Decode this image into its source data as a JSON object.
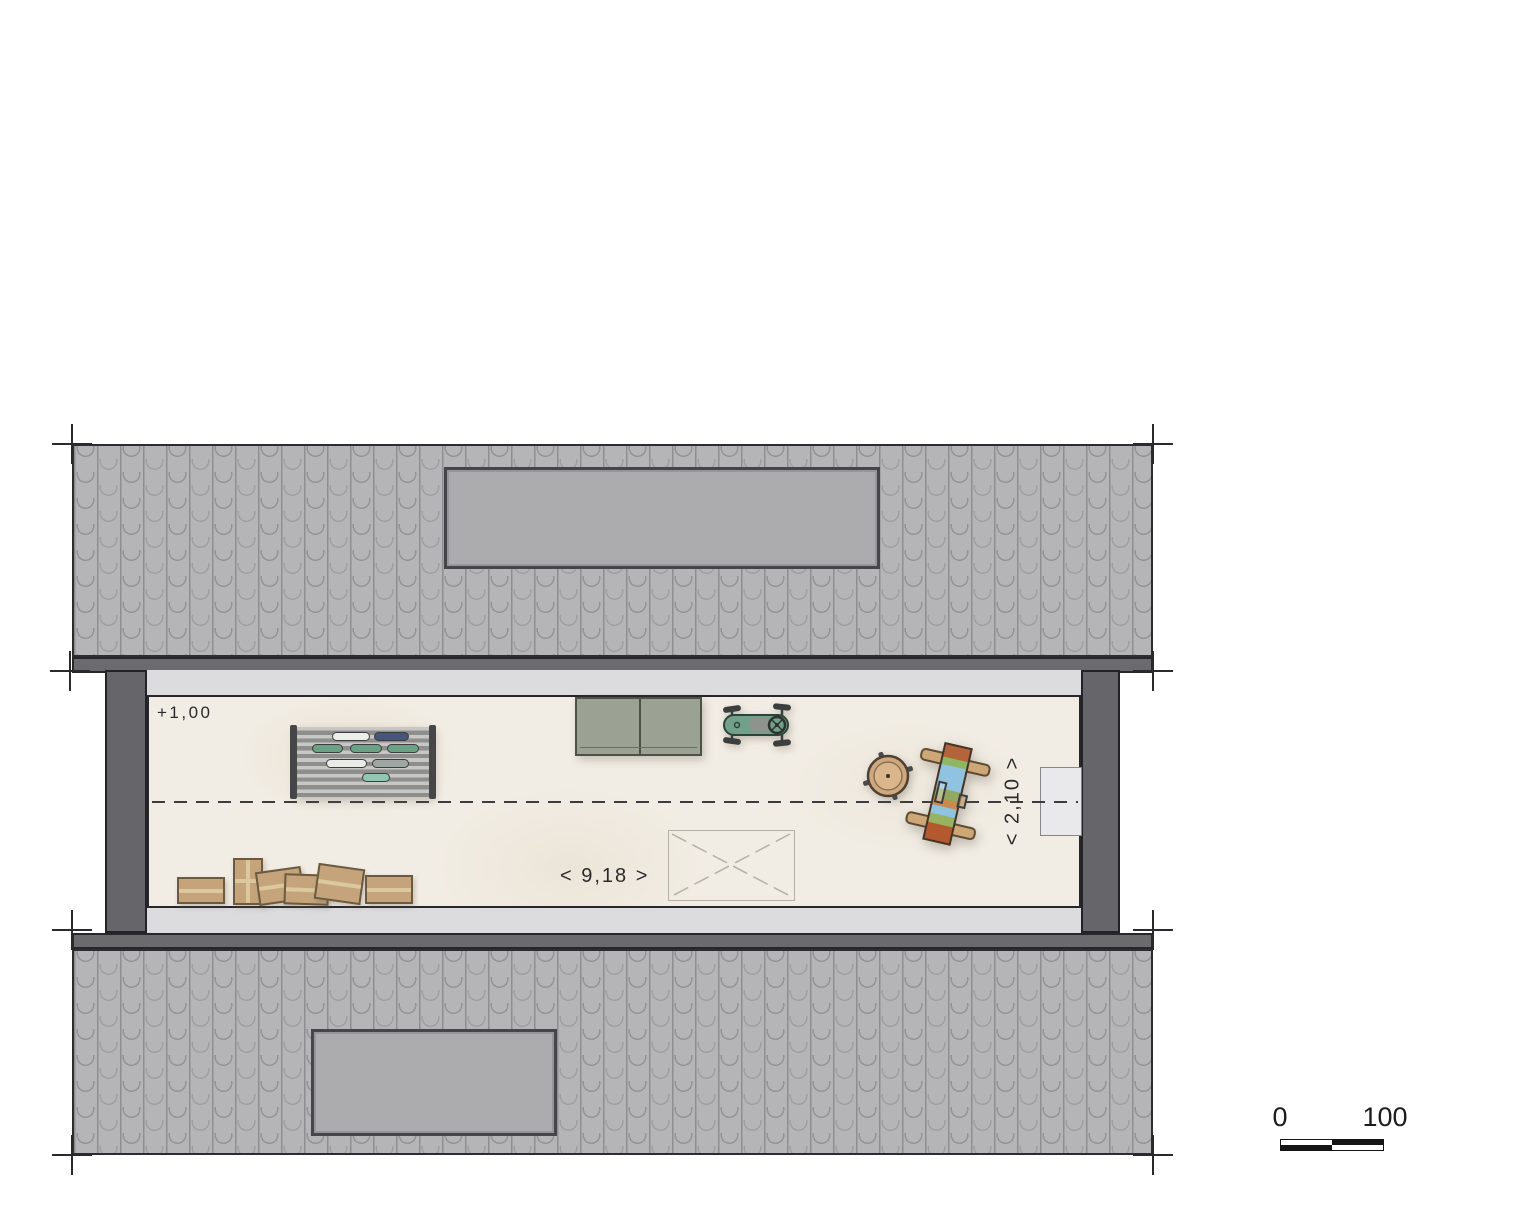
{
  "plan": {
    "level_label": "+1,00",
    "width_dimension": "< 9,18 >",
    "depth_dimension": "< 2,10 >"
  },
  "scale_bar": {
    "zero_label": "0",
    "hundred_label": "100"
  },
  "colors": {
    "roof_tile": "#b5b5b7",
    "roof_eave": "#6b6b6e",
    "wall": "#66666a",
    "floor": "#f2ede4",
    "band": "#dcdcde",
    "skylight": "#acacae",
    "cabinet": "#9ba294",
    "pedal_car": "#72a089",
    "stool": "#cfa87e",
    "cardboard_box": "#c5a47b",
    "rack_items": [
      "#eceeea",
      "#46557c",
      "#6ba184",
      "#93c7b4",
      "#9fa5a3"
    ]
  },
  "icons": {
    "skylight_top": "roof-skylight",
    "skylight_bottom": "roof-skylight",
    "storage_rack": "slatted-storage-rack",
    "storage_cabinet": "double-door-cabinet",
    "pedal_car": "pedal-car-top-view",
    "round_stool": "round-stool-top-view",
    "painted_workbench": "painted-workbench-top-view",
    "cardboard_boxes": "cardboard-box-pile",
    "floor_opening": "crossed-rectangle-opening"
  }
}
